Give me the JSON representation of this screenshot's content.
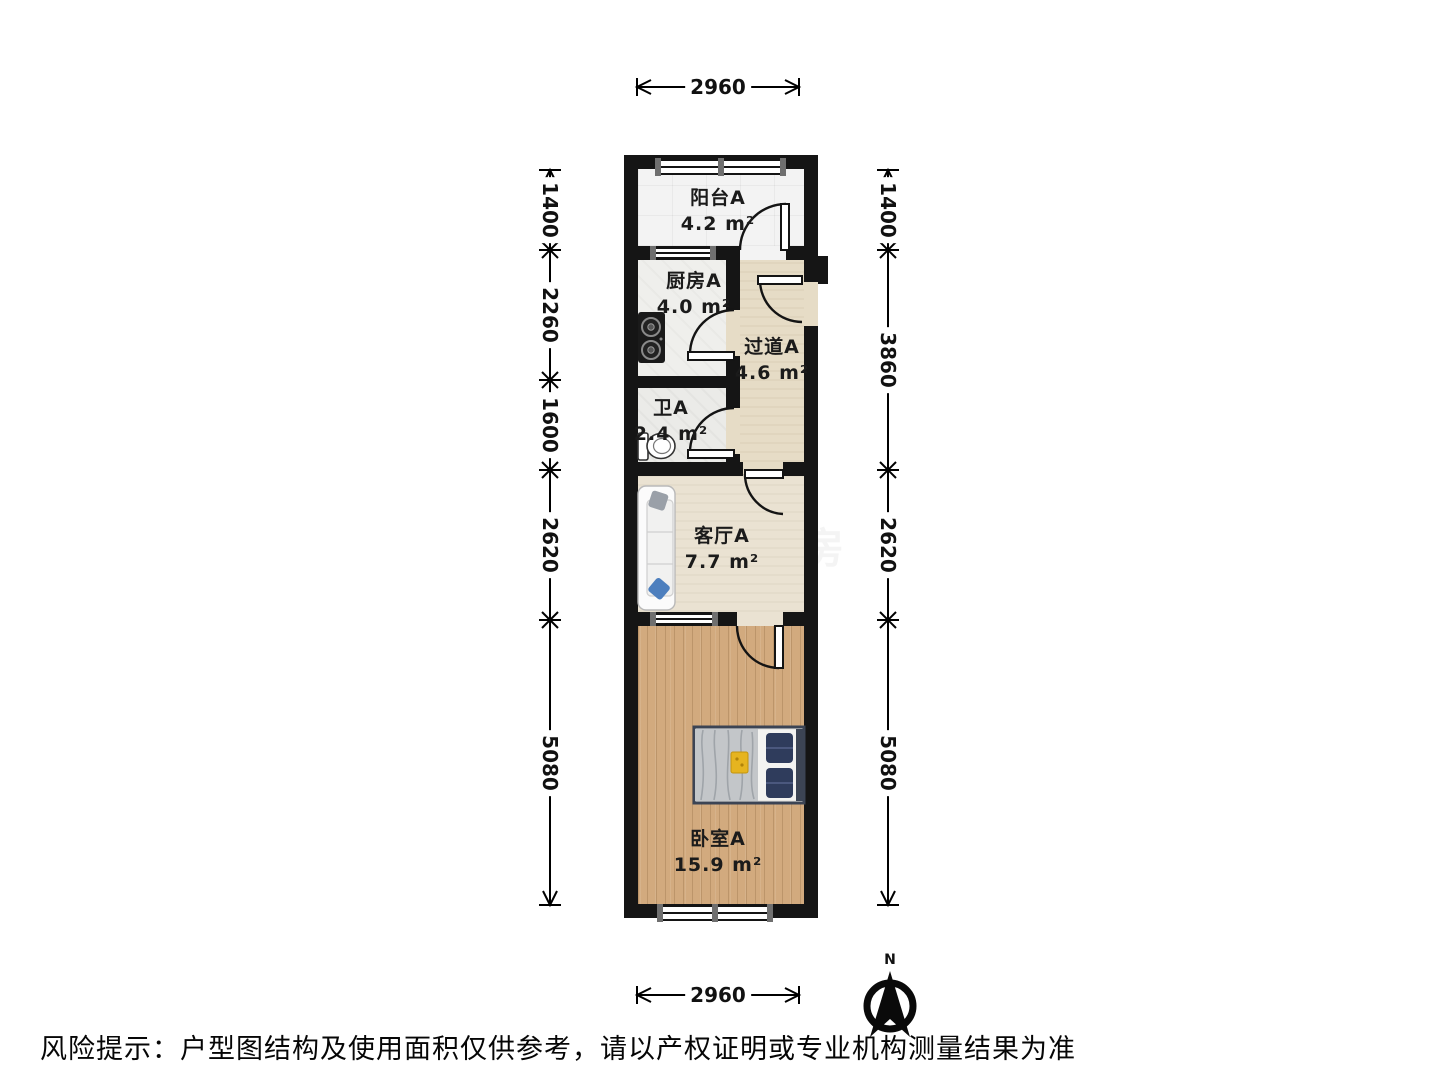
{
  "plan": {
    "rooms": [
      {
        "name": "阳台A",
        "area": "4.2 m²"
      },
      {
        "name": "厨房A",
        "area": "4.0 m²"
      },
      {
        "name": "过道A",
        "area": "4.6 m²"
      },
      {
        "name": "卫A",
        "area": "2.4 m²"
      },
      {
        "name": "客厅A",
        "area": "7.7 m²"
      },
      {
        "name": "卧室A",
        "area": "15.9 m²"
      }
    ],
    "dimensions": {
      "top": "2960",
      "bottom": "2960",
      "left": [
        "1400",
        "2260",
        "1600",
        "2620",
        "5080"
      ],
      "right": [
        "1400",
        "3860",
        "2620",
        "5080"
      ]
    },
    "compass_label": "N"
  },
  "footer": {
    "risk_notice": "风险提示：户型图结构及使用面积仅供参考，请以产权证明或专业机构测量结果为准"
  },
  "watermark": {
    "text": "找房",
    "glyph": "找"
  },
  "colors": {
    "wall": "#151515",
    "wood_floor": "#d2aa7e",
    "hall_floor": "#e6dcc6",
    "living_floor": "#eae2d2",
    "bed_frame": "#2f3c5c",
    "pillow_blue": "#4d7fbe",
    "stove_black": "#1a1a1a"
  }
}
